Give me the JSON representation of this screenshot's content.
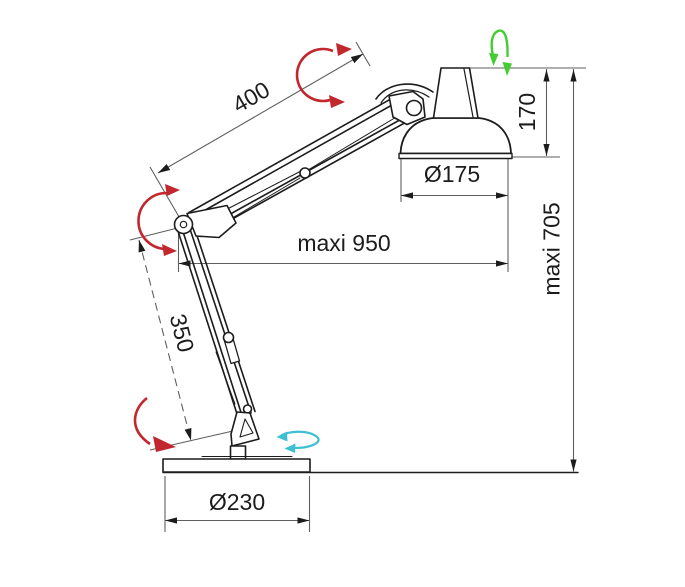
{
  "diagram": {
    "dimensions": {
      "upper_arm_length": {
        "label": "400",
        "value": 400
      },
      "lower_arm_length": {
        "label": "350",
        "value": 350
      },
      "head_height": {
        "label": "170",
        "value": 170
      },
      "shade_diameter": {
        "label": "Ø175",
        "value": 175
      },
      "max_reach": {
        "label": "maxi 950",
        "value": 950
      },
      "max_height": {
        "label": "maxi 705",
        "value": 705
      },
      "base_diameter": {
        "label": "Ø230",
        "value": 230
      }
    },
    "rotation_indicators": [
      {
        "name": "head-joint-rotation-arrow",
        "color_key": "red"
      },
      {
        "name": "elbow-rotation-arrow",
        "color_key": "red"
      },
      {
        "name": "base-joint-rotation-arrow",
        "color_key": "red"
      },
      {
        "name": "head-swivel-arrow",
        "color_key": "green"
      },
      {
        "name": "base-swivel-arrow",
        "color_key": "cyan"
      }
    ],
    "colors": {
      "line": "#1c1c1c",
      "dimension": "#5f5f5f",
      "red": "#c1272d",
      "green": "#44cc33",
      "cyan": "#3fbfd3",
      "background": "#ffffff"
    }
  }
}
